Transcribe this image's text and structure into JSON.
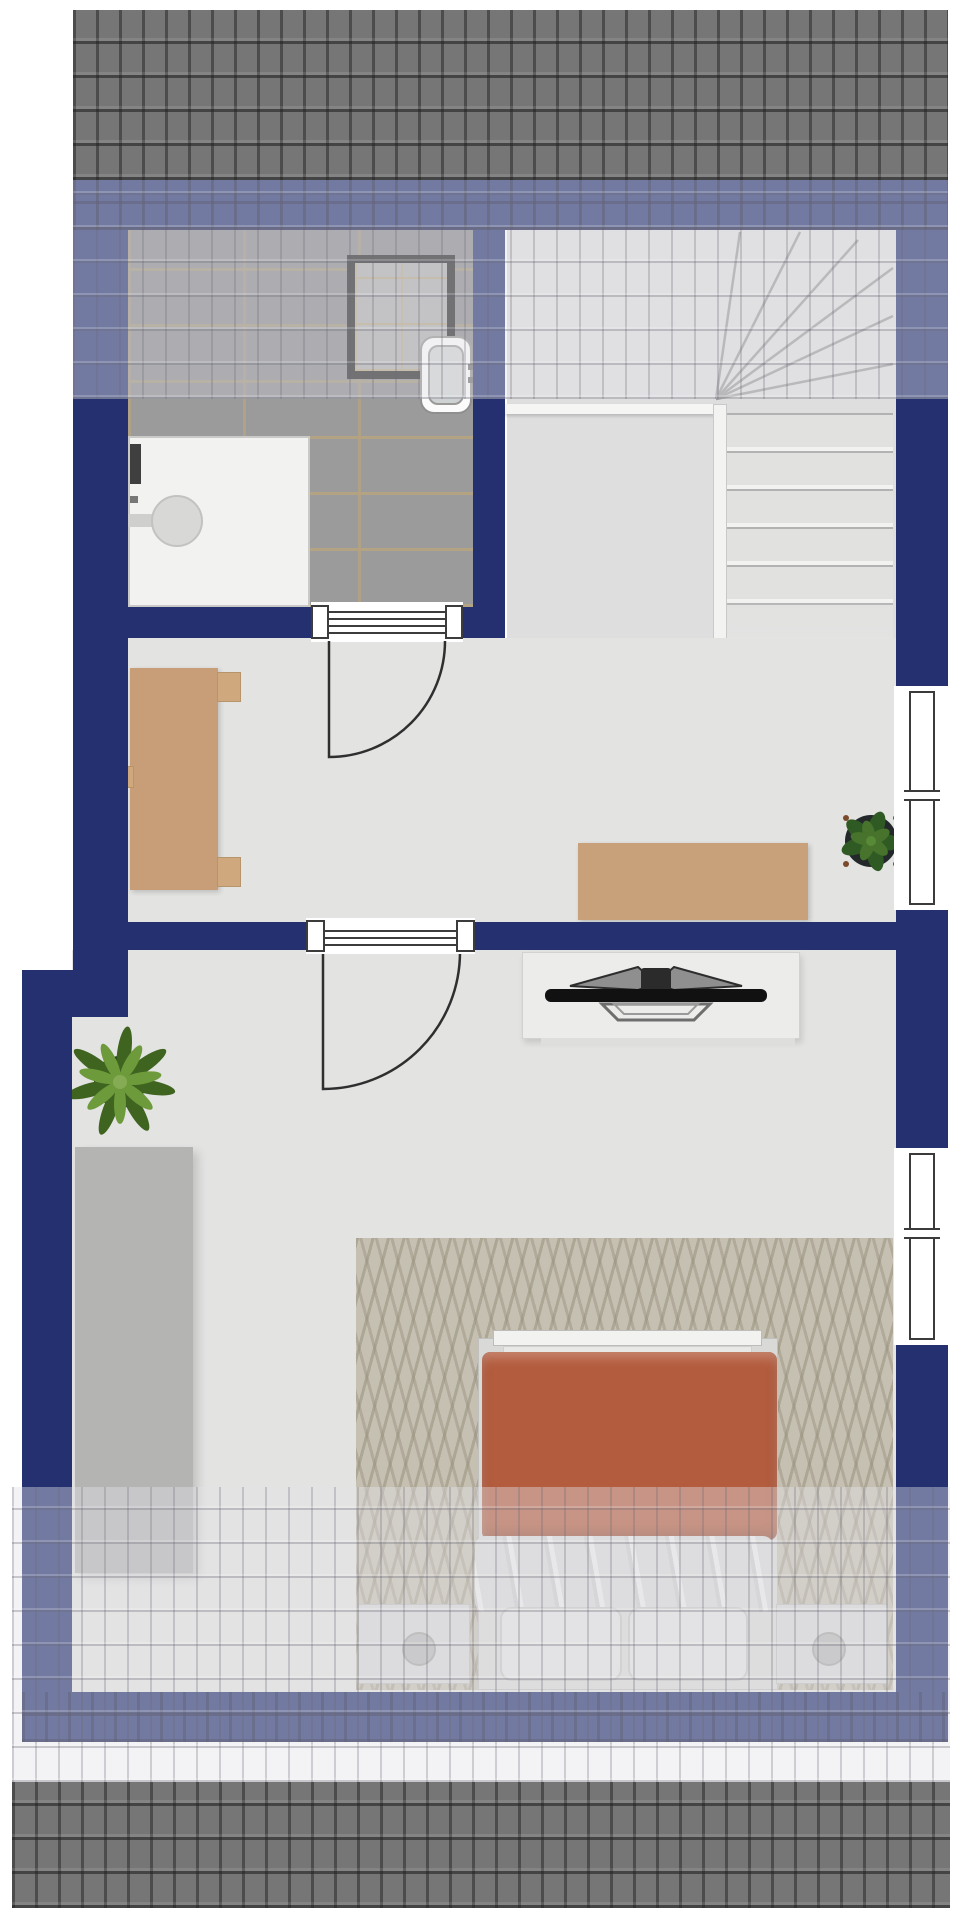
{
  "document": {
    "title": "Upper floor plan",
    "type": "floor-plan",
    "visible_text": ""
  },
  "colors": {
    "wall": "#24306f",
    "roof_dark": "#767676",
    "floor": "#e3e3e2",
    "bath_tile": "#9b9b9b",
    "grout": "#b3a383",
    "wardrobe": "#b4b4b3",
    "desk": "#c79e77",
    "desk2": "#c8a17b",
    "rug": "#c6c0b2",
    "duvet": "#b45c3e",
    "blanket": "#dadada",
    "lowboard": "#ececeb",
    "tv": "#111111",
    "window_frame": "#3b3b3b",
    "shower_frame": "#222222",
    "plant_dark": "#3f6420",
    "plant_light": "#6d9a3a"
  },
  "legend": {
    "rooms": [
      {
        "id": "bathroom",
        "label": "Bathroom",
        "furniture": [
          "shower",
          "washbasin",
          "shower-cabin"
        ]
      },
      {
        "id": "staircase",
        "label": "Winder staircase",
        "furniture": [
          "stair-treads",
          "winder-steps",
          "railing"
        ]
      },
      {
        "id": "landing-room",
        "label": "Landing room",
        "furniture": [
          "desk",
          "sideboard-desk",
          "potted-plant"
        ]
      },
      {
        "id": "bedroom",
        "label": "Bedroom",
        "furniture": [
          "wardrobe",
          "tv-lowboard",
          "television",
          "rug",
          "double-bed",
          "bedside-table-left",
          "bedside-table-right",
          "potted-plant"
        ]
      }
    ],
    "doors": [
      {
        "id": "bathroom-door",
        "label": "Bathroom door"
      },
      {
        "id": "bedroom-door",
        "label": "Bedroom door"
      }
    ],
    "windows": [
      {
        "id": "window-upper-right",
        "label": "Window upper right"
      },
      {
        "id": "window-lower-right",
        "label": "Window lower right"
      }
    ],
    "roof": {
      "label": "Roof slope bands",
      "count": 4
    }
  }
}
